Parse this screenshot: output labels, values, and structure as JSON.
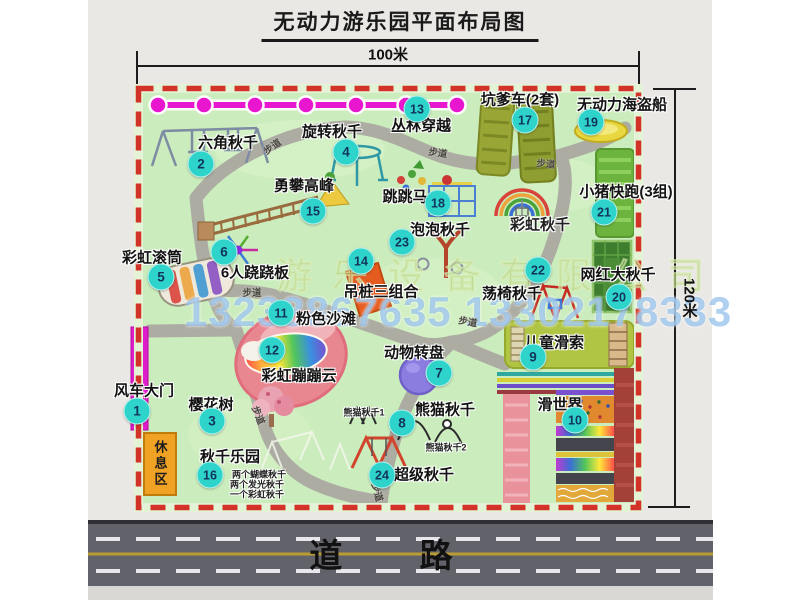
{
  "title": "无动力游乐园平面布局图",
  "dimensions": {
    "top": "100米",
    "right": "120米"
  },
  "road_label": "道 路",
  "rest_area_label": "休息区",
  "walkway_label": "步道",
  "watermark": {
    "company": "游乐设备有限公司",
    "phone": "13233867635 13302178333"
  },
  "colors": {
    "map_green": "#cbecbd",
    "border_red": "#d23227",
    "badge": "#2ed3ca",
    "gate_magenta": "#df1ecb",
    "jungle_line": "#e816ce",
    "road_gray": "#62626a",
    "rest_orange": "#f0a224",
    "beach_pink": "#e98791"
  },
  "attractions": [
    {
      "num": "1",
      "name": "风车大门",
      "bx": 137,
      "by": 411,
      "lx": 144,
      "ly": 390
    },
    {
      "num": "2",
      "name": "六角秋千",
      "bx": 201,
      "by": 164,
      "lx": 228,
      "ly": 142
    },
    {
      "num": "3",
      "name": "樱花树",
      "bx": 212,
      "by": 421,
      "lx": 211,
      "ly": 404
    },
    {
      "num": "4",
      "name": "旋转秋千",
      "bx": 346,
      "by": 152,
      "lx": 332,
      "ly": 131
    },
    {
      "num": "5",
      "name": "彩虹滚筒",
      "bx": 161,
      "by": 277,
      "lx": 152,
      "ly": 257
    },
    {
      "num": "6",
      "name": "6人跷跷板",
      "bx": 224,
      "by": 252,
      "lx": 255,
      "ly": 272
    },
    {
      "num": "7",
      "name": "动物转盘",
      "bx": 439,
      "by": 373,
      "lx": 414,
      "ly": 352
    },
    {
      "num": "8",
      "name": "熊猫秋千",
      "bx": 402,
      "by": 423,
      "lx": 445,
      "ly": 409
    },
    {
      "num": "9",
      "name": "儿童滑索",
      "bx": 533,
      "by": 357,
      "lx": 554,
      "ly": 342
    },
    {
      "num": "10",
      "name": "滑世界",
      "bx": 575,
      "by": 420,
      "lx": 560,
      "ly": 404
    },
    {
      "num": "11",
      "name": "粉色沙滩",
      "bx": 281,
      "by": 313,
      "lx": 326,
      "ly": 318
    },
    {
      "num": "12",
      "name": "彩虹蹦蹦云",
      "bx": 272,
      "by": 350,
      "lx": 299,
      "ly": 375
    },
    {
      "num": "13",
      "name": "丛林穿越",
      "bx": 417,
      "by": 109,
      "lx": 421,
      "ly": 125
    },
    {
      "num": "14",
      "name": "吊桩三组合",
      "bx": 361,
      "by": 261,
      "lx": 381,
      "ly": 291
    },
    {
      "num": "15",
      "name": "勇攀高峰",
      "bx": 313,
      "by": 211,
      "lx": 304,
      "ly": 185
    },
    {
      "num": "16",
      "name": "秋千乐园",
      "bx": 210,
      "by": 475,
      "lx": 230,
      "ly": 456
    },
    {
      "num": "17",
      "name": "坑爹车(2套)",
      "bx": 525,
      "by": 120,
      "lx": 520,
      "ly": 99
    },
    {
      "num": "18",
      "name": "跳跳马",
      "bx": 438,
      "by": 203,
      "lx": 405,
      "ly": 196
    },
    {
      "num": "19",
      "name": "无动力海盗船",
      "bx": 591,
      "by": 122,
      "lx": 622,
      "ly": 104
    },
    {
      "num": "20",
      "name": "网红大秋千",
      "bx": 619,
      "by": 297,
      "lx": 618,
      "ly": 274
    },
    {
      "num": "21",
      "name": "小猪快跑(3组)",
      "bx": 604,
      "by": 212,
      "lx": 626,
      "ly": 191
    },
    {
      "num": "22",
      "name": "荡椅秋千",
      "bx": 538,
      "by": 270,
      "lx": 512,
      "ly": 293
    },
    {
      "num": "23",
      "name": "泡泡秋千",
      "bx": 402,
      "by": 242,
      "lx": 440,
      "ly": 229
    },
    {
      "num": "24",
      "name": "超级秋千",
      "bx": 382,
      "by": 475,
      "lx": 424,
      "ly": 474
    }
  ],
  "notes": [
    {
      "text": "彩虹秋千",
      "x": 540,
      "y": 224,
      "size": 15
    },
    {
      "text": "熊猫秋千1",
      "x": 364,
      "y": 412,
      "size": 9
    },
    {
      "text": "熊猫秋千2",
      "x": 446,
      "y": 447,
      "size": 9
    },
    {
      "text": "两个蝴蝶秋千",
      "x": 259,
      "y": 474,
      "size": 9
    },
    {
      "text": "两个发光秋千",
      "x": 257,
      "y": 484,
      "size": 9
    },
    {
      "text": "一个彩虹秋千",
      "x": 257,
      "y": 494,
      "size": 9
    }
  ],
  "walkways": [
    {
      "x": 272,
      "y": 146,
      "rot": -35
    },
    {
      "x": 438,
      "y": 152,
      "rot": 8
    },
    {
      "x": 546,
      "y": 163,
      "rot": 5
    },
    {
      "x": 252,
      "y": 292,
      "rot": 0
    },
    {
      "x": 259,
      "y": 415,
      "rot": 68
    },
    {
      "x": 468,
      "y": 321,
      "rot": 10
    },
    {
      "x": 378,
      "y": 492,
      "rot": 75
    }
  ]
}
